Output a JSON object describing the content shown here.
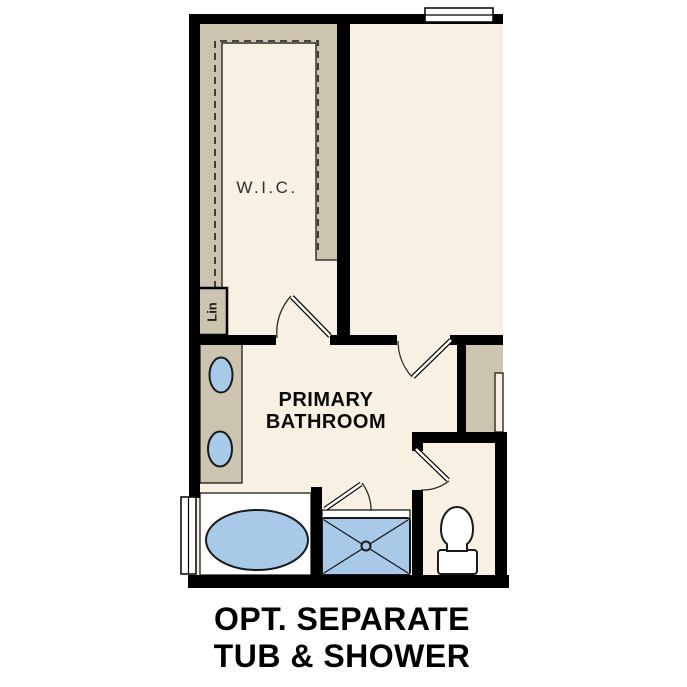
{
  "title": "Primary bathroom floor plan option",
  "labels": {
    "wic": "W.I.C.",
    "linen": "Lin",
    "bathroom_line1": "PRIMARY",
    "bathroom_line2": "BATHROOM"
  },
  "caption": {
    "line1": "OPT. SEPARATE",
    "line2": "TUB & SHOWER"
  },
  "fixtures": {
    "sinks": "double-sink-vanity",
    "tub": "oval-soaking-tub",
    "shower": "separate-shower-with-drain",
    "toilet": "toilet-in-water-closet",
    "windows": "2",
    "doors": "4"
  },
  "colors": {
    "wall": "#000000",
    "floor": "#f8f0e3",
    "cabinet": "#cdc4af",
    "fixture": "#a9c9e9",
    "outline": "#1a1a1a",
    "text": "#111111"
  }
}
